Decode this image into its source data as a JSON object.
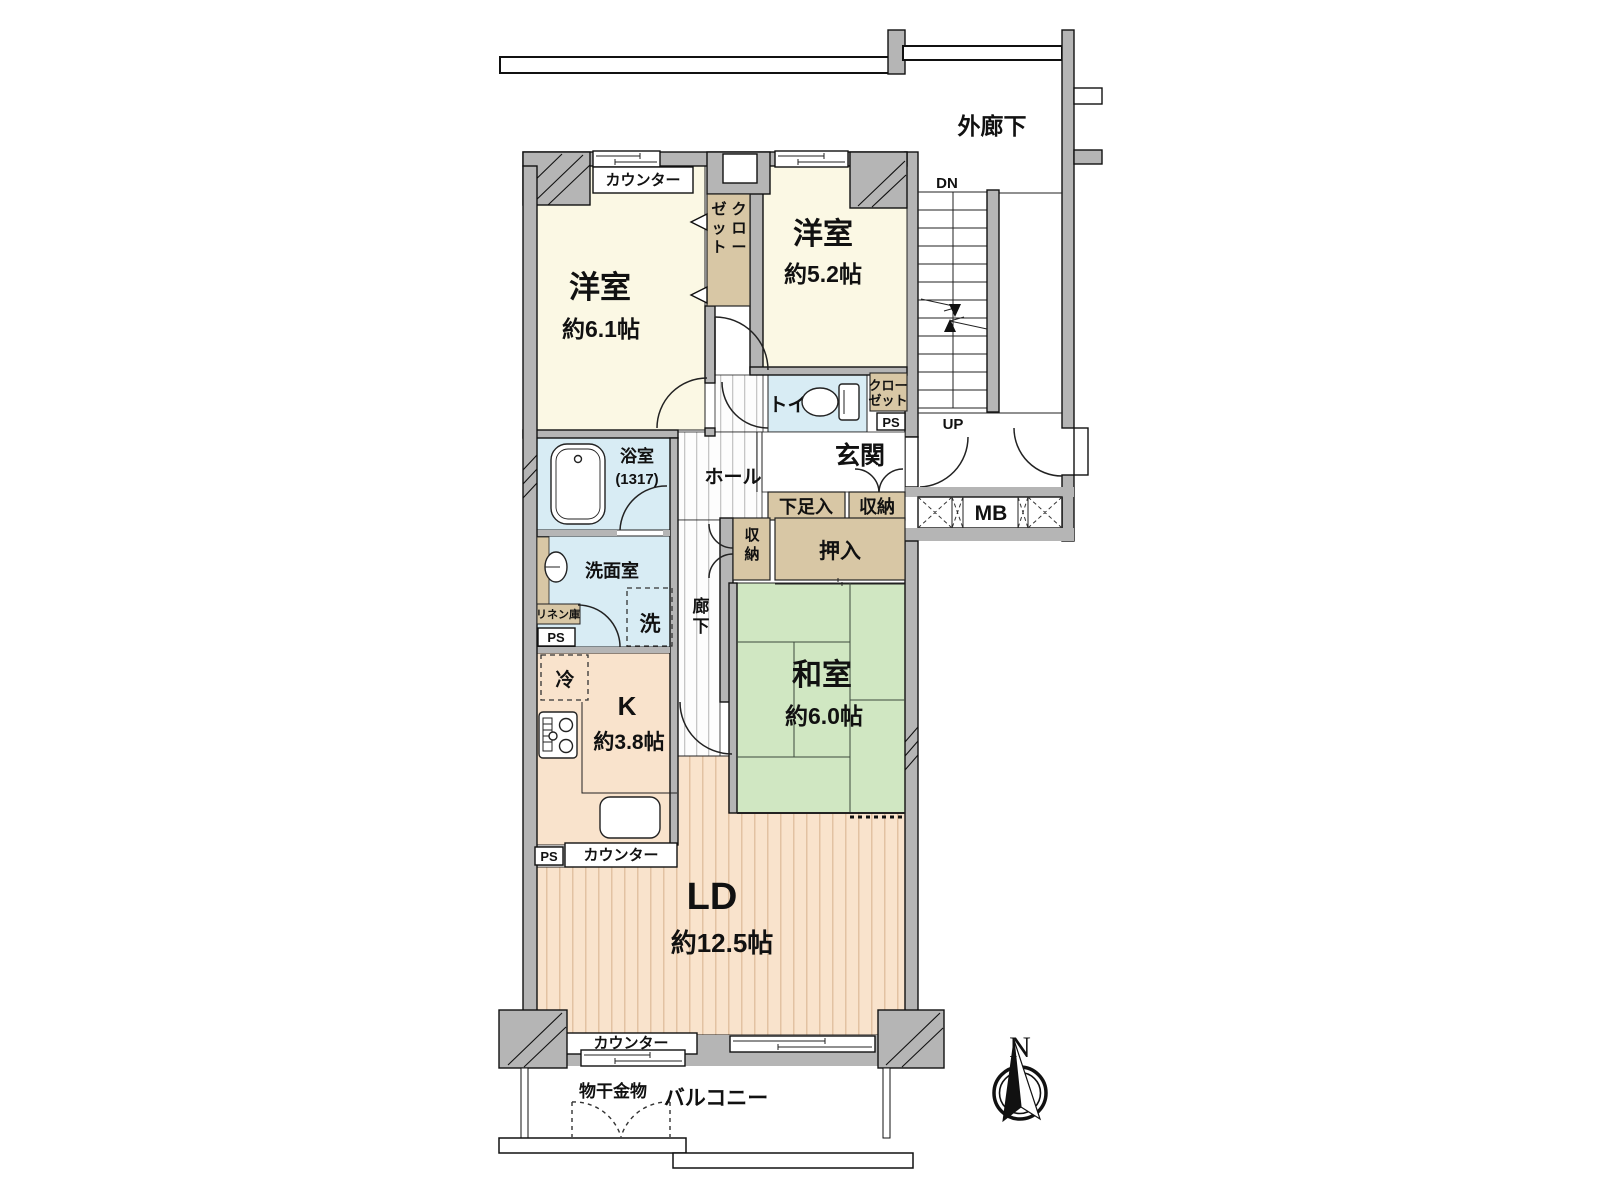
{
  "plan": {
    "outer_corridor": "外廊下",
    "stair_down": "DN",
    "stair_up": "UP",
    "meter_box": "MB",
    "ps": "PS",
    "counter": "カウンター",
    "compass_north": "N",
    "rooms": {
      "western1": {
        "name": "洋室",
        "size": "約6.1帖"
      },
      "western2": {
        "name": "洋室",
        "size": "約5.2帖"
      },
      "japanese": {
        "name": "和室",
        "size": "約6.0帖"
      },
      "kitchen": {
        "name": "K",
        "size": "約3.8帖"
      },
      "living": {
        "name": "LD",
        "size": "約12.5帖"
      },
      "bath": {
        "name": "浴室",
        "size": "(1317)"
      },
      "washroom": {
        "name": "洗面室"
      },
      "toilet": {
        "name": "トイレ"
      },
      "entrance": {
        "name": "玄関"
      },
      "hall": {
        "name": "ホール"
      },
      "corridor": {
        "name": "廊下"
      },
      "balcony": {
        "name": "バルコニー"
      }
    },
    "storage": {
      "closet1_col1": "クロー",
      "closet1_col2": "ゼット",
      "closet2_line1": "クロー",
      "closet2_line2": "ゼット",
      "shoe_box": "下足入",
      "entrance_storage": "収納",
      "hall_storage": "収納",
      "oshiire": "押入",
      "linen": "リネン庫"
    },
    "fixtures": {
      "washer": "洗",
      "fridge": "冷",
      "laundry_hanger": "物干金物"
    },
    "palette": {
      "wall_gray": "#b5b5b5",
      "western_room": "#fbf8e4",
      "tatami_green": "#d0e7c2",
      "wet_area_blue": "#d8ecf4",
      "wood_floor": "#f9e3cc",
      "storage_tan": "#d8c7a5"
    }
  }
}
